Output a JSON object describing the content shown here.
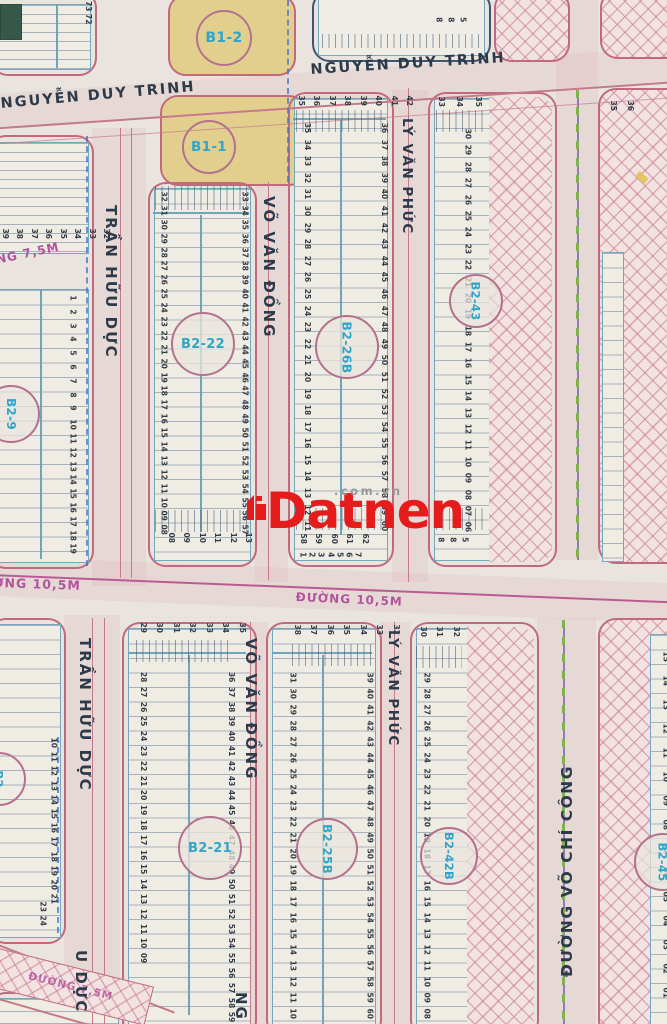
{
  "watermark": {
    "brand": "Datnen",
    "domain": ".com.vn"
  },
  "streets": {
    "nguyen_duy_trinh": "NGUYỄN DUY TRINH",
    "tran_huu_duc": "TRẦN HỮU DỰC",
    "vo_van_dong": "VÕ VĂN ĐỒNG",
    "ly_van_phuc": "LÝ VĂN PHỨC",
    "vo_chi_cong": "ĐƯỜNG VÕ CHÍ CÔNG",
    "duong_105m": "ĐƯỜNG 10,5M",
    "duong_75m": "ĐƯỜNG 7,5M",
    "partial_u_duc": "U DỰC",
    "partial_ng": "NG"
  },
  "blocks": {
    "b1_2": "B1-2",
    "b1_1": "B1-1",
    "b2_22": "B2-22",
    "b2_26b": "B2-26B",
    "b2_43": "B2-43",
    "b2_9": "B2-9",
    "b2_21": "B2-21",
    "b2_25b": "B2-25B",
    "b2_42b": "B2-42B",
    "b2_45": "B2-45",
    "b2_partial": "B2"
  },
  "palette": {
    "paper": "#e9e5de",
    "block_border_pink": "#c2697e",
    "inner_teal": "#6ea6b8",
    "lot_number_navy": "#333c46",
    "circle_text_cyan": "#2fa6c9",
    "street_text": "#2c3a4a",
    "magenta_label": "#b3539b",
    "hatch_pink": "#c97b8e",
    "yellow_block": "#e3cf8d",
    "watermark_red": "#e61c1c",
    "watermark_gray": "#979797",
    "median_green": "#7fb24c",
    "median_purple": "#8f7cb4",
    "dash_blue": "#4a6fd0",
    "green_patch": "#35584a"
  },
  "lot_cols": [
    {
      "x": 80,
      "y": 0,
      "p": 13,
      "nums": [
        "73",
        "72"
      ]
    },
    {
      "x": 155,
      "y": 190,
      "p": 13.9,
      "nums": [
        "32",
        "31",
        "30",
        "29",
        "28",
        "27",
        "26",
        "25",
        "24",
        "23",
        "22",
        "21",
        "20",
        "19",
        "18",
        "17",
        "16",
        "15",
        "14",
        "13",
        "12",
        "11",
        "10",
        "09",
        "08"
      ]
    },
    {
      "x": 236,
      "y": 190,
      "p": 13.9,
      "nums": [
        "33",
        "34",
        "35",
        "36",
        "37",
        "38",
        "39",
        "40",
        "41",
        "42",
        "43",
        "44",
        "45",
        "46",
        "47",
        "48",
        "49",
        "50",
        "51",
        "52",
        "53",
        "54",
        "55",
        "56",
        "57"
      ]
    },
    {
      "x": 297,
      "y": 120,
      "p": 16.6,
      "nums": [
        "35",
        "34",
        "33",
        "32",
        "31",
        "30",
        "29",
        "28",
        "27",
        "26",
        "25",
        "24",
        "23",
        "22",
        "21",
        "20",
        "19",
        "18",
        "17",
        "16",
        "15",
        "14",
        "13",
        "12",
        "11"
      ]
    },
    {
      "x": 374,
      "y": 120,
      "p": 16.6,
      "nums": [
        "36",
        "37",
        "38",
        "39",
        "40",
        "41",
        "42",
        "43",
        "44",
        "45",
        "46",
        "47",
        "48",
        "49",
        "50",
        "51",
        "52",
        "53",
        "54",
        "55",
        "56",
        "57",
        "58",
        "59",
        "60"
      ]
    },
    {
      "x": 458,
      "y": 126,
      "p": 16.4,
      "nums": [
        "30",
        "29",
        "28",
        "27",
        "26",
        "25",
        "24",
        "23",
        "22",
        "21",
        "20",
        "19",
        "18",
        "17",
        "16",
        "15",
        "14",
        "13",
        "12",
        "11",
        "10",
        "09",
        "08",
        "07",
        "06"
      ]
    },
    {
      "x": 64,
      "y": 294,
      "p": 13.8,
      "nums": [
        "1",
        "2",
        "3",
        "4",
        "5",
        "6",
        "7",
        "8",
        "9",
        "10",
        "11",
        "12",
        "13",
        "14",
        "15",
        "16",
        "17",
        "18",
        "19"
      ]
    },
    {
      "x": 134,
      "y": 670,
      "p": 14.8,
      "nums": [
        "28",
        "27",
        "26",
        "25",
        "24",
        "23",
        "22",
        "21",
        "20",
        "19",
        "18",
        "17",
        "16",
        "15",
        "14",
        "13",
        "12",
        "11",
        "10",
        "09"
      ]
    },
    {
      "x": 222,
      "y": 670,
      "p": 14.8,
      "nums": [
        "36",
        "37",
        "38",
        "39",
        "40",
        "41",
        "42",
        "43",
        "44",
        "45",
        "46",
        "47",
        "48",
        "49",
        "50",
        "51",
        "52",
        "53",
        "54",
        "55",
        "56",
        "57",
        "58",
        "59"
      ]
    },
    {
      "x": 283,
      "y": 670,
      "p": 16,
      "nums": [
        "31",
        "30",
        "29",
        "28",
        "27",
        "26",
        "25",
        "24",
        "23",
        "22",
        "21",
        "20",
        "19",
        "18",
        "17",
        "16",
        "15",
        "14",
        "13",
        "12",
        "11",
        "10"
      ]
    },
    {
      "x": 360,
      "y": 670,
      "p": 16,
      "nums": [
        "39",
        "40",
        "41",
        "42",
        "43",
        "44",
        "45",
        "46",
        "47",
        "48",
        "49",
        "50",
        "51",
        "52",
        "53",
        "54",
        "55",
        "56",
        "57",
        "58",
        "59",
        "60"
      ]
    },
    {
      "x": 417,
      "y": 670,
      "p": 16,
      "nums": [
        "29",
        "28",
        "27",
        "26",
        "25",
        "24",
        "23",
        "22",
        "21",
        "20",
        "19",
        "18",
        "17",
        "16",
        "15",
        "14",
        "13",
        "12",
        "11",
        "10",
        "09",
        "08"
      ]
    },
    {
      "x": 45,
      "y": 736,
      "p": 14.2,
      "nums": [
        "10",
        "11",
        "12",
        "13",
        "14",
        "15",
        "16",
        "17",
        "18",
        "19",
        "20",
        "21"
      ]
    },
    {
      "x": 34,
      "y": 900,
      "p": 14,
      "nums": [
        "23",
        "24"
      ]
    },
    {
      "x": 652,
      "y": 645,
      "p": 24,
      "nums": [
        "15",
        "14",
        "13",
        "12",
        "11",
        "10",
        "09",
        "08",
        "07",
        "06",
        "05",
        "04",
        "03",
        "02",
        "01"
      ]
    }
  ],
  "lot_rows": [
    {
      "x": 436,
      "y": 16,
      "g": 7,
      "nums": [
        "8",
        "8",
        "5"
      ]
    },
    {
      "x": 296,
      "y": 97,
      "g": 5,
      "nums": [
        "35",
        "36",
        "37",
        "38",
        "39",
        "40",
        "41",
        "42"
      ]
    },
    {
      "x": 436,
      "y": 98,
      "g": 8,
      "nums": [
        "33",
        "34",
        "35"
      ]
    },
    {
      "x": 608,
      "y": 102,
      "g": 7,
      "nums": [
        "35",
        "36"
      ]
    },
    {
      "x": 0,
      "y": 230,
      "g": 4,
      "nums": [
        "39",
        "38",
        "37",
        "36",
        "35",
        "34",
        "33",
        "32"
      ]
    },
    {
      "x": 166,
      "y": 534,
      "g": 5,
      "nums": [
        "08",
        "09",
        "10",
        "11",
        "12",
        "13"
      ]
    },
    {
      "x": 298,
      "y": 535,
      "g": 5,
      "nums": [
        "58",
        "59",
        "60",
        "61",
        "62"
      ]
    },
    {
      "x": 300,
      "y": 551,
      "g": 4,
      "nums": [
        "1",
        "2",
        "3",
        "4",
        "5",
        "6",
        "7"
      ]
    },
    {
      "x": 438,
      "y": 536,
      "g": 7,
      "nums": [
        "8",
        "8",
        "5"
      ]
    },
    {
      "x": 138,
      "y": 624,
      "g": 6,
      "nums": [
        "29",
        "30",
        "31",
        "32",
        "33",
        "34",
        "35"
      ]
    },
    {
      "x": 292,
      "y": 626,
      "g": 6,
      "nums": [
        "38",
        "37",
        "36",
        "35",
        "34",
        "33",
        "32"
      ]
    },
    {
      "x": 418,
      "y": 628,
      "g": 6,
      "nums": [
        "30",
        "31",
        "32"
      ]
    },
    {
      "x": 14,
      "y": 984,
      "g": 10,
      "nums": [
        "39",
        "36"
      ]
    }
  ]
}
